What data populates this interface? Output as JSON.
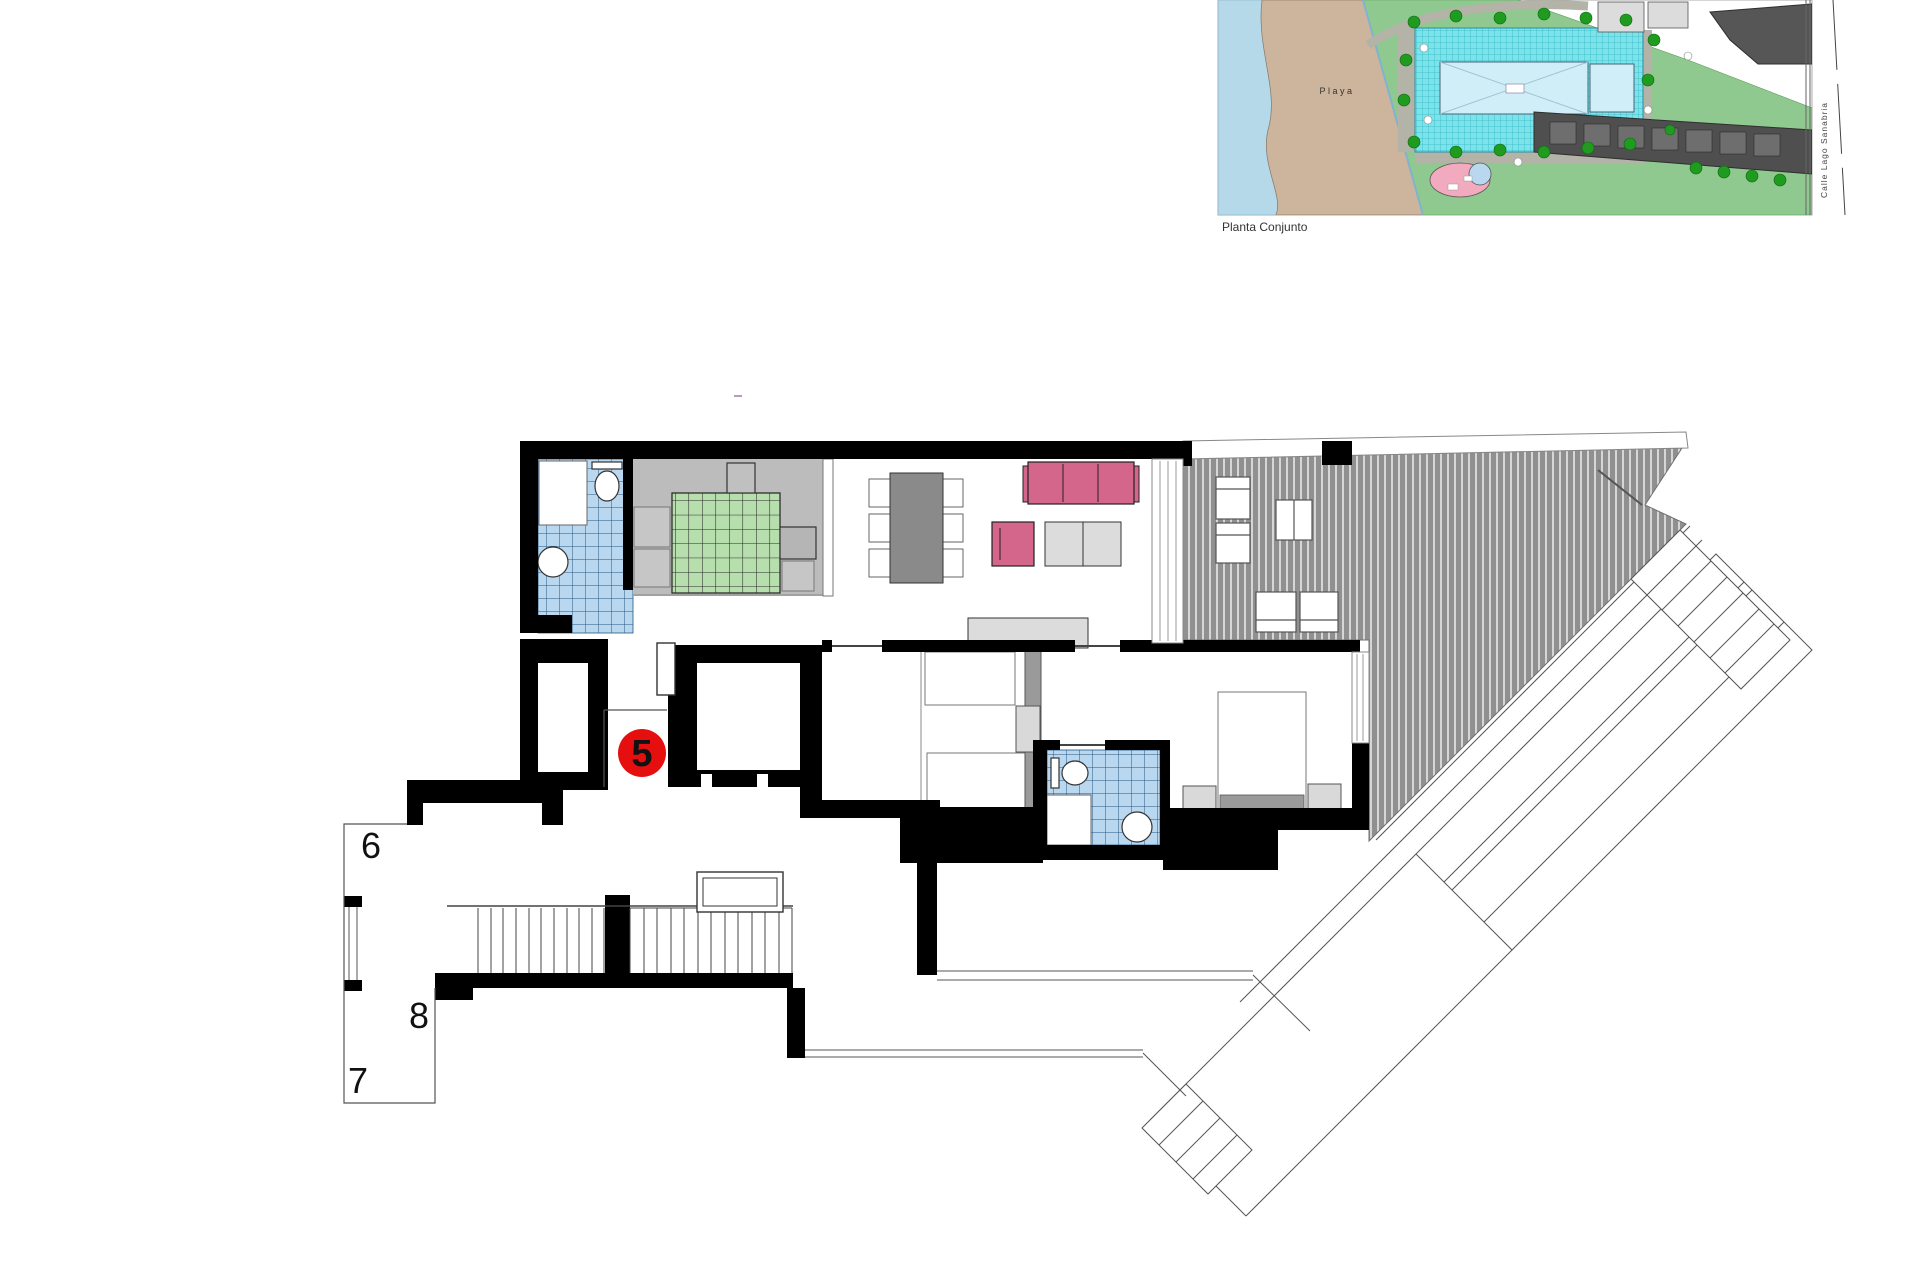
{
  "site_plan": {
    "caption": "Planta Conjunto",
    "labels": {
      "beach": "Playa",
      "street": "Calle Lago Sanabria"
    },
    "colors": {
      "sea": "#b5d9e8",
      "sand": "#cdb49c",
      "grass": "#8fc98f",
      "pool_deck": "#7ce3ea",
      "pool_water": "#cfeef7",
      "tree": "#1f9b1f",
      "path": "#b3b3a8",
      "building_dark": "#4f4f4f",
      "pond_pink": "#f2abbe"
    }
  },
  "floor_plan": {
    "unit_badge": {
      "number": "5",
      "color": "#e50f0f"
    },
    "neighbor_units": [
      {
        "number": "6"
      },
      {
        "number": "8"
      },
      {
        "number": "7"
      }
    ],
    "colors": {
      "wall": "#000000",
      "tile_blue": "#b9d8f0",
      "tile_grid": "#27567f",
      "bed_green": "#b7dfae",
      "floor_gray": "#bcbcbc",
      "furniture_gray": "#dcdcdc",
      "sofa_pink": "#d4668c",
      "terrace": "#909090"
    }
  }
}
